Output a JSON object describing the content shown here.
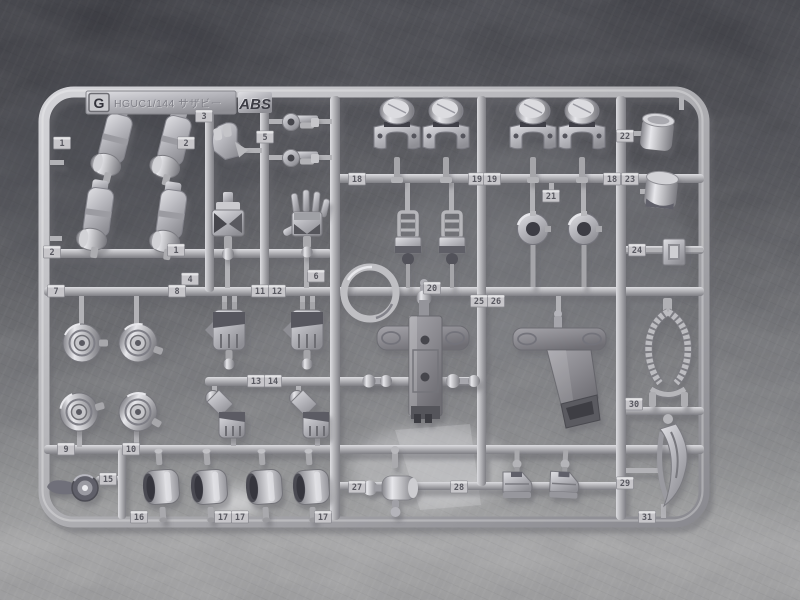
{
  "runner": {
    "letter": "G",
    "kit": "HGUC1/144 サザビー",
    "material": "ABS"
  },
  "part_tags": [
    "1",
    "2",
    "3",
    "5",
    "2",
    "1",
    "4",
    "6",
    "7",
    "8",
    "9",
    "10",
    "11",
    "12",
    "13",
    "14",
    "15",
    "16",
    "17",
    "17",
    "17",
    "18",
    "19",
    "19",
    "18",
    "20",
    "21",
    "22",
    "23",
    "24",
    "25",
    "26",
    "27",
    "28",
    "29",
    "30",
    "31"
  ],
  "colors": {
    "plastic": "#b6b6bc",
    "plastic_highlight": "#e2e2e6",
    "plastic_shadow": "#7c7c82",
    "large_part_gray": "#8b8a90",
    "background_top": "#55565c",
    "background_bottom": "#a7a7a8",
    "tag_plate": "#c7c6ca"
  }
}
